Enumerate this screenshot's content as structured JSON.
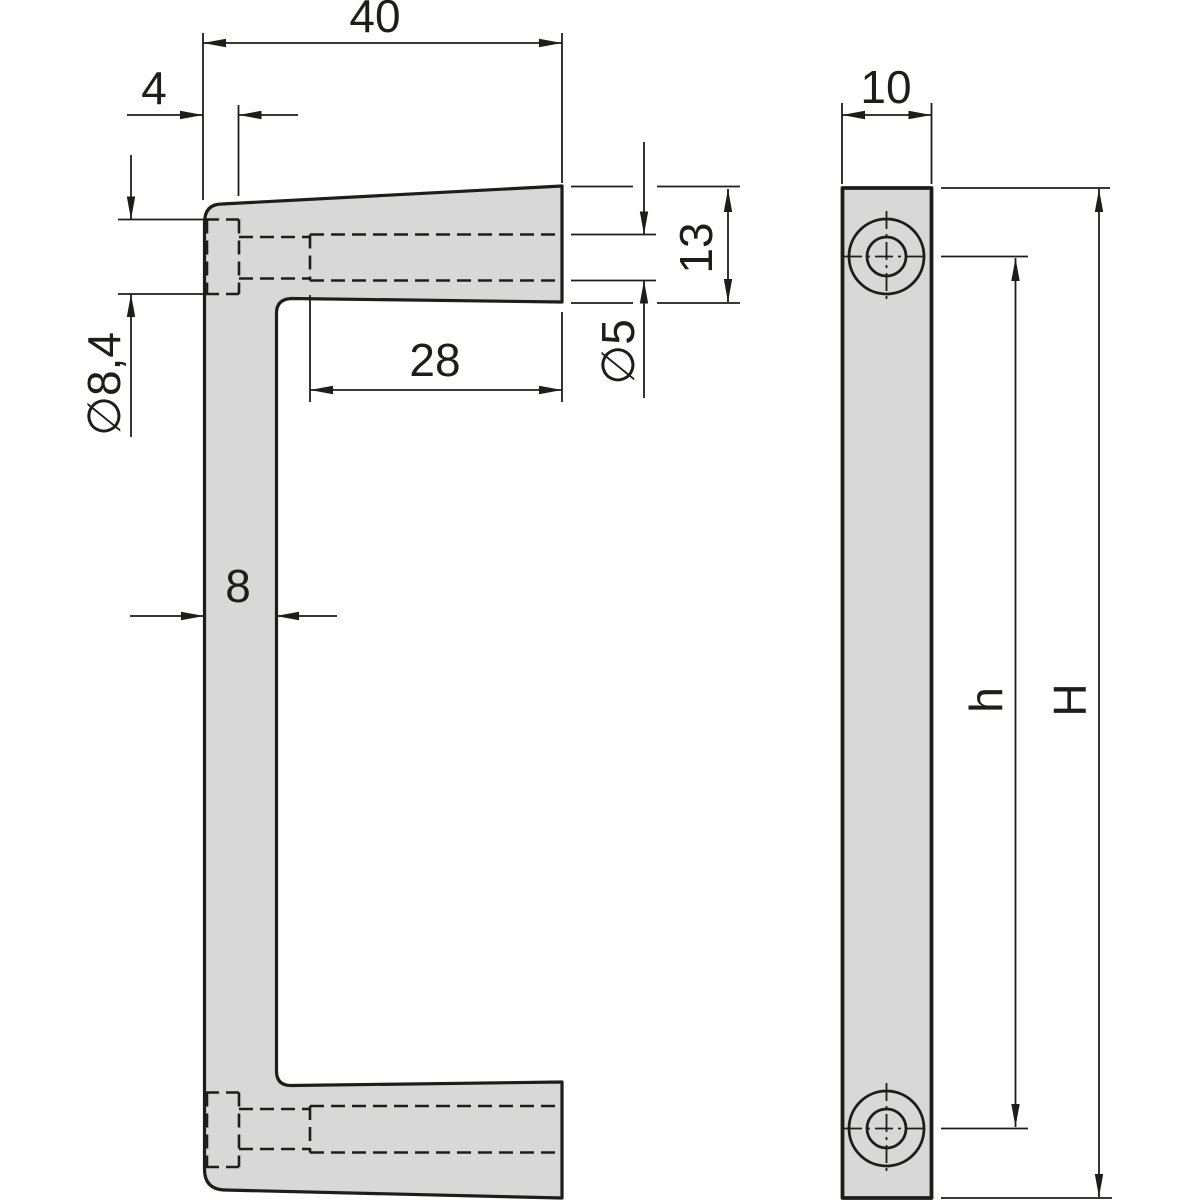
{
  "drawing": {
    "description": "Two-view technical drawing of a front panel handle with counterbored mounting holes",
    "dims": {
      "overall_width": "40",
      "cb_depth": "4",
      "cb_dia": "∅8,4",
      "hole_depth": "28",
      "hole_dia": "∅5",
      "end_height": "13",
      "thickness": "8",
      "profile_width": "10",
      "hole_dist": "h",
      "total_height": "H"
    },
    "colors": {
      "part_fill": "#d8d8d8",
      "line": "#1d1d1b",
      "background": "#ffffff"
    }
  }
}
